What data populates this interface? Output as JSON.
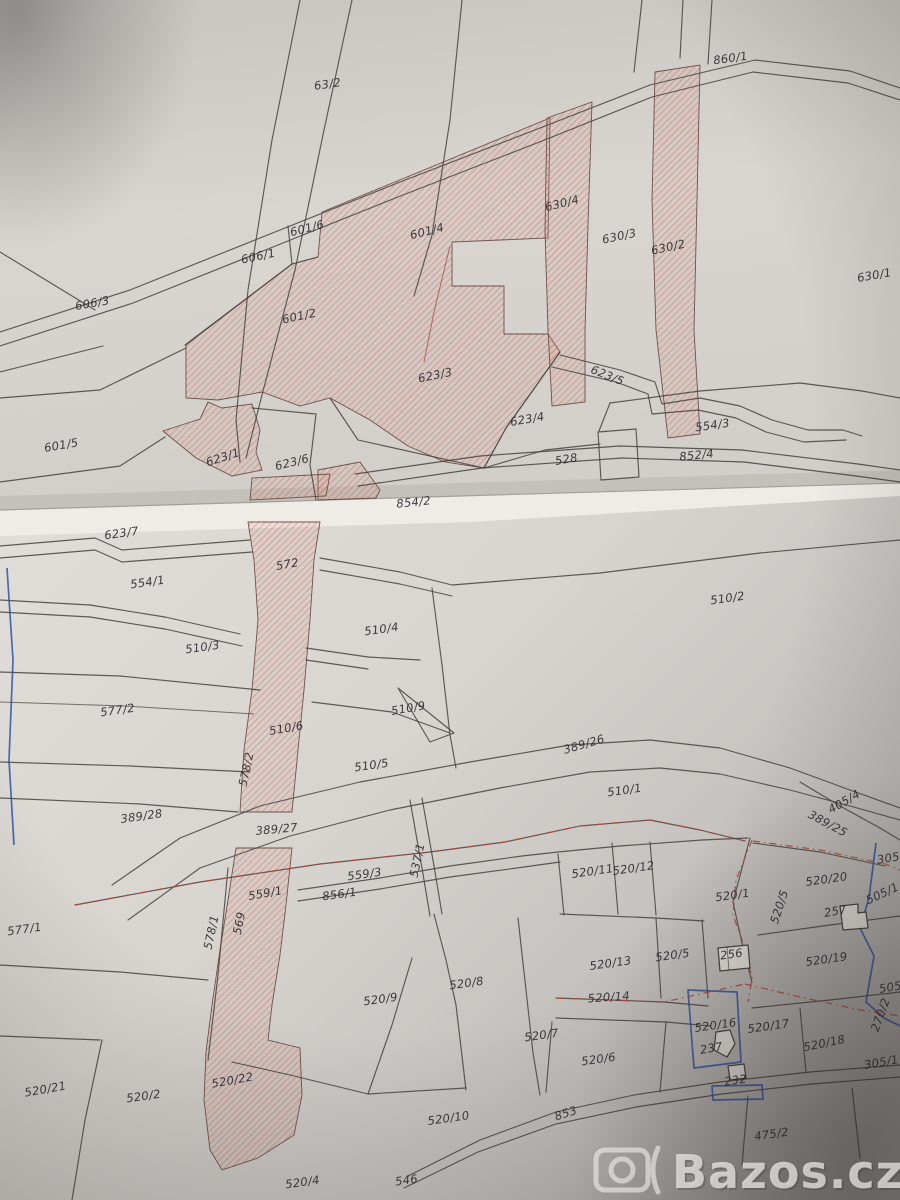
{
  "photo": {
    "description": "photograph of a folded paper cadastral map with highlighted parcels",
    "watermark": {
      "icon": "camera-icon",
      "text": "Bazos.cz"
    }
  },
  "map": {
    "colors": {
      "hatch": "#b65a4e",
      "line": "#45423e",
      "blue": "#3053a4",
      "dash": "#b5483c",
      "label": "#2b2a2e",
      "paper": "#d8d4d0"
    },
    "labels": [
      {
        "t": "63/2",
        "x": 328,
        "y": 88,
        "r": -8
      },
      {
        "t": "860/1",
        "x": 731,
        "y": 62,
        "r": -8
      },
      {
        "t": "601/6",
        "x": 308,
        "y": 232,
        "r": -14
      },
      {
        "t": "606/1",
        "x": 259,
        "y": 260,
        "r": -12
      },
      {
        "t": "601/4",
        "x": 428,
        "y": 235,
        "r": -14
      },
      {
        "t": "630/4",
        "x": 563,
        "y": 207,
        "r": -14
      },
      {
        "t": "630/3",
        "x": 620,
        "y": 240,
        "r": -12
      },
      {
        "t": "630/2",
        "x": 669,
        "y": 251,
        "r": -12
      },
      {
        "t": "630/1",
        "x": 875,
        "y": 279,
        "r": -10
      },
      {
        "t": "606/3",
        "x": 93,
        "y": 307,
        "r": -10
      },
      {
        "t": "601/2",
        "x": 300,
        "y": 320,
        "r": -12
      },
      {
        "t": "623/3",
        "x": 436,
        "y": 379,
        "r": -12
      },
      {
        "t": "623/5",
        "x": 606,
        "y": 379,
        "r": 22
      },
      {
        "t": "623/4",
        "x": 528,
        "y": 423,
        "r": -10
      },
      {
        "t": "554/3",
        "x": 713,
        "y": 429,
        "r": -8
      },
      {
        "t": "852/4",
        "x": 697,
        "y": 459,
        "r": -6
      },
      {
        "t": "601/5",
        "x": 62,
        "y": 449,
        "r": -10
      },
      {
        "t": "623/1",
        "x": 224,
        "y": 461,
        "r": -18
      },
      {
        "t": "623/6",
        "x": 293,
        "y": 466,
        "r": -14
      },
      {
        "t": "528",
        "x": 567,
        "y": 463,
        "r": -10
      },
      {
        "t": "854/2",
        "x": 414,
        "y": 506,
        "r": -6
      },
      {
        "t": "623/7",
        "x": 122,
        "y": 537,
        "r": -8
      },
      {
        "t": "554/1",
        "x": 148,
        "y": 586,
        "r": -8
      },
      {
        "t": "572",
        "x": 288,
        "y": 568,
        "r": -10
      },
      {
        "t": "510/2",
        "x": 728,
        "y": 602,
        "r": -8
      },
      {
        "t": "510/3",
        "x": 203,
        "y": 651,
        "r": -8
      },
      {
        "t": "510/4",
        "x": 382,
        "y": 633,
        "r": -8
      },
      {
        "t": "577/2",
        "x": 118,
        "y": 714,
        "r": -8
      },
      {
        "t": "510/6",
        "x": 287,
        "y": 732,
        "r": -10
      },
      {
        "t": "578/2",
        "x": 250,
        "y": 770,
        "r": -78
      },
      {
        "t": "510/9",
        "x": 409,
        "y": 712,
        "r": -10
      },
      {
        "t": "510/5",
        "x": 372,
        "y": 769,
        "r": -8
      },
      {
        "t": "389/26",
        "x": 585,
        "y": 748,
        "r": -16
      },
      {
        "t": "510/1",
        "x": 625,
        "y": 794,
        "r": -8
      },
      {
        "t": "405/4",
        "x": 846,
        "y": 805,
        "r": -30
      },
      {
        "t": "389/25",
        "x": 826,
        "y": 827,
        "r": 28
      },
      {
        "t": "389/28",
        "x": 142,
        "y": 820,
        "r": -8
      },
      {
        "t": "389/27",
        "x": 277,
        "y": 833,
        "r": -5
      },
      {
        "t": "537/1",
        "x": 421,
        "y": 861,
        "r": -78
      },
      {
        "t": "559/3",
        "x": 365,
        "y": 878,
        "r": -8
      },
      {
        "t": "856/1",
        "x": 340,
        "y": 898,
        "r": -8
      },
      {
        "t": "559/1",
        "x": 266,
        "y": 897,
        "r": -10
      },
      {
        "t": "569",
        "x": 243,
        "y": 924,
        "r": -78
      },
      {
        "t": "578/1",
        "x": 215,
        "y": 933,
        "r": -78
      },
      {
        "t": "577/1",
        "x": 25,
        "y": 933,
        "r": -8
      },
      {
        "t": "520/11",
        "x": 593,
        "y": 875,
        "r": -8
      },
      {
        "t": "520/12",
        "x": 634,
        "y": 872,
        "r": -8
      },
      {
        "t": "520/1",
        "x": 733,
        "y": 899,
        "r": -8
      },
      {
        "t": "520/20",
        "x": 827,
        "y": 883,
        "r": -8
      },
      {
        "t": "505/1",
        "x": 884,
        "y": 897,
        "r": -25
      },
      {
        "t": "305",
        "x": 889,
        "y": 862,
        "r": -10
      },
      {
        "t": "520/5",
        "x": 783,
        "y": 908,
        "r": -72
      },
      {
        "t": "257",
        "x": 836,
        "y": 915,
        "r": -10
      },
      {
        "t": "520/13",
        "x": 611,
        "y": 967,
        "r": -8
      },
      {
        "t": "520/5",
        "x": 673,
        "y": 959,
        "r": -8
      },
      {
        "t": "256",
        "x": 732,
        "y": 958,
        "r": -8
      },
      {
        "t": "520/19",
        "x": 827,
        "y": 963,
        "r": -8
      },
      {
        "t": "505",
        "x": 891,
        "y": 991,
        "r": -10
      },
      {
        "t": "520/14",
        "x": 609,
        "y": 1001,
        "r": -4
      },
      {
        "t": "270/2",
        "x": 884,
        "y": 1016,
        "r": -70
      },
      {
        "t": "520/16",
        "x": 716,
        "y": 1029,
        "r": -8
      },
      {
        "t": "520/17",
        "x": 769,
        "y": 1030,
        "r": -8
      },
      {
        "t": "520/18",
        "x": 825,
        "y": 1047,
        "r": -12
      },
      {
        "t": "520/6",
        "x": 599,
        "y": 1063,
        "r": -8
      },
      {
        "t": "237",
        "x": 712,
        "y": 1052,
        "r": -10
      },
      {
        "t": "232",
        "x": 736,
        "y": 1084,
        "r": -8
      },
      {
        "t": "305/1",
        "x": 882,
        "y": 1066,
        "r": -10
      },
      {
        "t": "520/9",
        "x": 381,
        "y": 1003,
        "r": -8
      },
      {
        "t": "520/8",
        "x": 467,
        "y": 987,
        "r": -8
      },
      {
        "t": "520/7",
        "x": 542,
        "y": 1039,
        "r": -8
      },
      {
        "t": "520/10",
        "x": 449,
        "y": 1122,
        "r": -8
      },
      {
        "t": "853",
        "x": 567,
        "y": 1117,
        "r": -18
      },
      {
        "t": "520/21",
        "x": 46,
        "y": 1093,
        "r": -10
      },
      {
        "t": "520/2",
        "x": 144,
        "y": 1100,
        "r": -8
      },
      {
        "t": "520/22",
        "x": 233,
        "y": 1084,
        "r": -10
      },
      {
        "t": "520/4",
        "x": 303,
        "y": 1186,
        "r": -8
      },
      {
        "t": "546",
        "x": 407,
        "y": 1184,
        "r": -8
      },
      {
        "t": "475/2",
        "x": 772,
        "y": 1138,
        "r": -8
      }
    ]
  }
}
